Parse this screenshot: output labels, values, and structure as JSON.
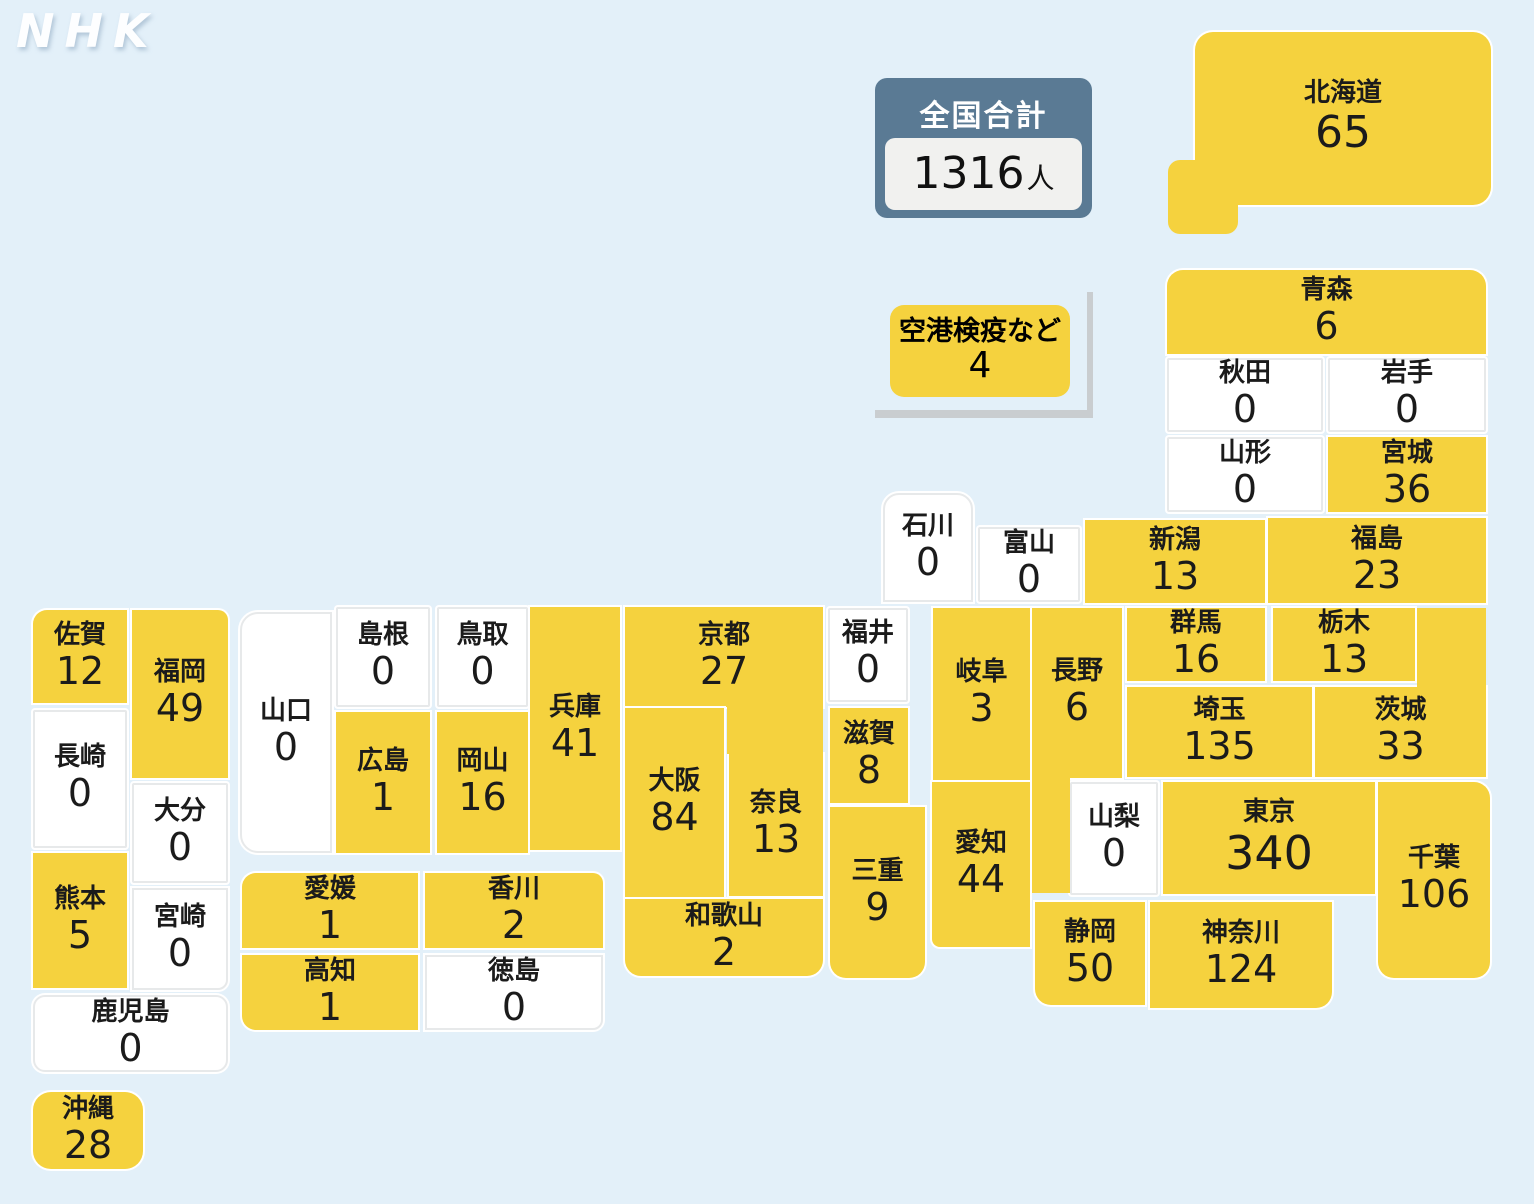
{
  "page": {
    "background": "#e3f0f9"
  },
  "logo": {
    "text": "NHK"
  },
  "colors": {
    "filled": "#f5d23e",
    "empty": "#ffffff",
    "accent": "#5a7a94",
    "bracket": "#c9cdd0"
  },
  "total": {
    "label": "全国合計",
    "value": "1316",
    "unit": "人"
  },
  "airport": {
    "label": "空港検疫など",
    "value": "4"
  },
  "regions": [
    {
      "id": "hokkaido",
      "name": "北海道",
      "value": "65",
      "filled": true
    },
    {
      "id": "aomori",
      "name": "青森",
      "value": "6",
      "filled": true
    },
    {
      "id": "akita",
      "name": "秋田",
      "value": "0",
      "filled": false
    },
    {
      "id": "iwate",
      "name": "岩手",
      "value": "0",
      "filled": false
    },
    {
      "id": "yamagata",
      "name": "山形",
      "value": "0",
      "filled": false
    },
    {
      "id": "miyagi",
      "name": "宮城",
      "value": "36",
      "filled": true
    },
    {
      "id": "niigata",
      "name": "新潟",
      "value": "13",
      "filled": true
    },
    {
      "id": "fukushima",
      "name": "福島",
      "value": "23",
      "filled": true
    },
    {
      "id": "gunma",
      "name": "群馬",
      "value": "16",
      "filled": true
    },
    {
      "id": "tochigi",
      "name": "栃木",
      "value": "13",
      "filled": true
    },
    {
      "id": "ibaraki",
      "name": "茨城",
      "value": "33",
      "filled": true
    },
    {
      "id": "saitama",
      "name": "埼玉",
      "value": "135",
      "filled": true
    },
    {
      "id": "yamanashi",
      "name": "山梨",
      "value": "0",
      "filled": false
    },
    {
      "id": "tokyo",
      "name": "東京",
      "value": "340",
      "filled": true
    },
    {
      "id": "chiba",
      "name": "千葉",
      "value": "106",
      "filled": true
    },
    {
      "id": "shizuoka",
      "name": "静岡",
      "value": "50",
      "filled": true
    },
    {
      "id": "kanagawa",
      "name": "神奈川",
      "value": "124",
      "filled": true
    },
    {
      "id": "ishikawa",
      "name": "石川",
      "value": "0",
      "filled": false
    },
    {
      "id": "toyama",
      "name": "富山",
      "value": "0",
      "filled": false
    },
    {
      "id": "fukui",
      "name": "福井",
      "value": "0",
      "filled": false
    },
    {
      "id": "gifu",
      "name": "岐阜",
      "value": "3",
      "filled": true
    },
    {
      "id": "nagano",
      "name": "長野",
      "value": "6",
      "filled": true
    },
    {
      "id": "aichi",
      "name": "愛知",
      "value": "44",
      "filled": true
    },
    {
      "id": "shiga",
      "name": "滋賀",
      "value": "8",
      "filled": true
    },
    {
      "id": "mie",
      "name": "三重",
      "value": "9",
      "filled": true
    },
    {
      "id": "kyoto",
      "name": "京都",
      "value": "27",
      "filled": true
    },
    {
      "id": "osaka",
      "name": "大阪",
      "value": "84",
      "filled": true
    },
    {
      "id": "nara",
      "name": "奈良",
      "value": "13",
      "filled": true
    },
    {
      "id": "wakayama",
      "name": "和歌山",
      "value": "2",
      "filled": true
    },
    {
      "id": "hyogo",
      "name": "兵庫",
      "value": "41",
      "filled": true
    },
    {
      "id": "tottori",
      "name": "鳥取",
      "value": "0",
      "filled": false
    },
    {
      "id": "shimane",
      "name": "島根",
      "value": "0",
      "filled": false
    },
    {
      "id": "yamaguchi",
      "name": "山口",
      "value": "0",
      "filled": false
    },
    {
      "id": "hiroshima",
      "name": "広島",
      "value": "1",
      "filled": true
    },
    {
      "id": "okayama",
      "name": "岡山",
      "value": "16",
      "filled": true
    },
    {
      "id": "ehime",
      "name": "愛媛",
      "value": "1",
      "filled": true
    },
    {
      "id": "kagawa",
      "name": "香川",
      "value": "2",
      "filled": true
    },
    {
      "id": "kochi",
      "name": "高知",
      "value": "1",
      "filled": true
    },
    {
      "id": "tokushima",
      "name": "徳島",
      "value": "0",
      "filled": false
    },
    {
      "id": "saga",
      "name": "佐賀",
      "value": "12",
      "filled": true
    },
    {
      "id": "fukuoka",
      "name": "福岡",
      "value": "49",
      "filled": true
    },
    {
      "id": "nagasaki",
      "name": "長崎",
      "value": "0",
      "filled": false
    },
    {
      "id": "oita",
      "name": "大分",
      "value": "0",
      "filled": false
    },
    {
      "id": "kumamoto",
      "name": "熊本",
      "value": "5",
      "filled": true
    },
    {
      "id": "miyazaki",
      "name": "宮崎",
      "value": "0",
      "filled": false
    },
    {
      "id": "kagoshima",
      "name": "鹿児島",
      "value": "0",
      "filled": false
    },
    {
      "id": "okinawa",
      "name": "沖縄",
      "value": "28",
      "filled": true
    }
  ]
}
